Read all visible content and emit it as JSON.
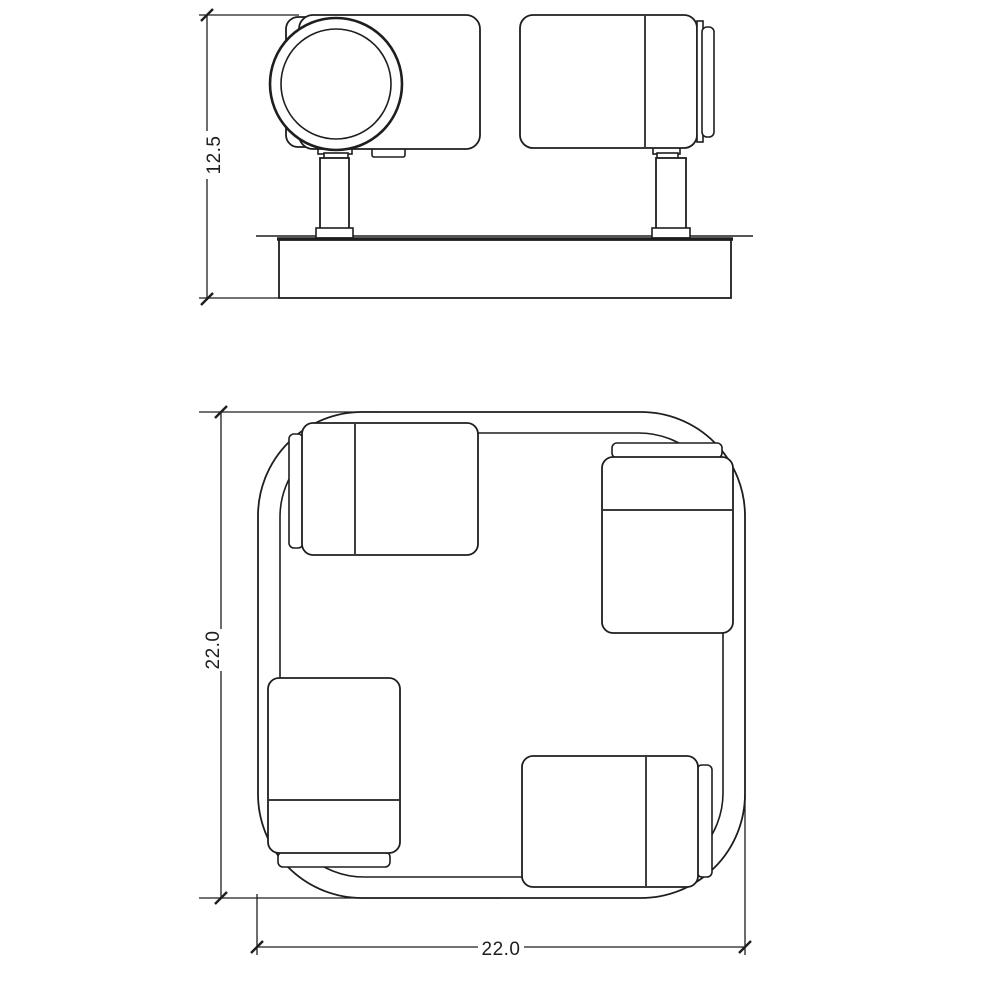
{
  "drawing": {
    "background_color": "#ffffff",
    "line_color": "#1e1e1e",
    "views": {
      "side_view": {
        "height_dimension_label": "12.5"
      },
      "plan_view": {
        "vertical_dimension_label": "22.0",
        "horizontal_dimension_label": "22.0"
      }
    }
  }
}
